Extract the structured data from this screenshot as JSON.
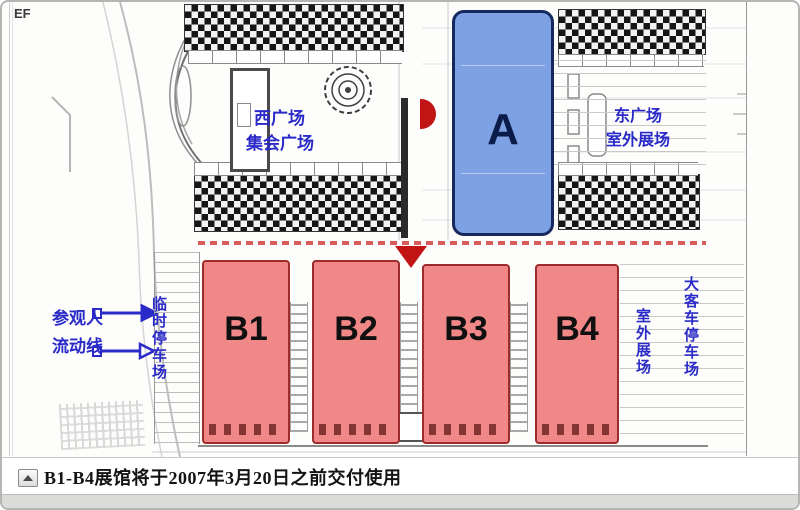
{
  "page": {
    "corner_label": "EF",
    "frame_border_color": "#b5b5b3",
    "background": "#fdfdfc"
  },
  "map": {
    "halls": [
      {
        "id": "A",
        "label": "A",
        "fill": "#7da1e2",
        "border": "#16295e"
      },
      {
        "id": "B1",
        "label": "B1",
        "fill": "#f08888",
        "border": "#9e2b2b"
      },
      {
        "id": "B2",
        "label": "B2",
        "fill": "#f08888",
        "border": "#9e2b2b"
      },
      {
        "id": "B3",
        "label": "B3",
        "fill": "#f08888",
        "border": "#9e2b2b"
      },
      {
        "id": "B4",
        "label": "B4",
        "fill": "#f08888",
        "border": "#9e2b2b"
      }
    ],
    "annotations": {
      "west_square_line1": "西广场",
      "west_square_line2": "集会广场",
      "east_square_line1": "东广场",
      "east_square_line2": "室外展场",
      "visitor_flow_line1": "参观人",
      "visitor_flow_line2": "流动线",
      "temp_parking_vertical": "临时停车场",
      "outdoor_exhibition_vertical": "室外展场",
      "bus_parking_vertical": "大客车停车场",
      "note_color": "#2a2ac8"
    },
    "markers": {
      "entrance_marker_color": "#c11414"
    }
  },
  "caption": {
    "icon": "triangle-up",
    "text": "B1-B4展馆将于2007年3月20日之前交付使用"
  }
}
